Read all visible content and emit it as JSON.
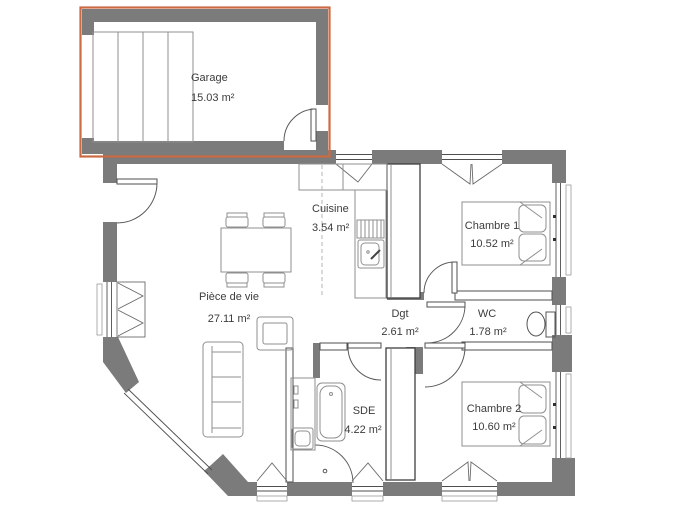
{
  "title": "House floor plan",
  "colors": {
    "wall": "#7b7b7b",
    "accent": "#cc6a43",
    "label": "#3c3c3c"
  },
  "rooms": {
    "garage": {
      "name": "Garage",
      "area": "15.03 m²"
    },
    "cuisine": {
      "name": "Cuisine",
      "area": "3.54 m²"
    },
    "chambre1": {
      "name": "Chambre 1",
      "area": "10.52 m²"
    },
    "piece_de_vie": {
      "name": "Pièce de vie",
      "area": "27.11 m²"
    },
    "dgt": {
      "name": "Dgt",
      "area": "2.61 m²"
    },
    "wc": {
      "name": "WC",
      "area": "1.78 m²"
    },
    "sde": {
      "name": "SDE",
      "area": "4.22 m²"
    },
    "chambre2": {
      "name": "Chambre 2",
      "area": "10.60 m²"
    }
  },
  "icons": {
    "door_swing": "quarter-arc",
    "window_casement": "triangle",
    "garage_door": "sectional-panels"
  }
}
